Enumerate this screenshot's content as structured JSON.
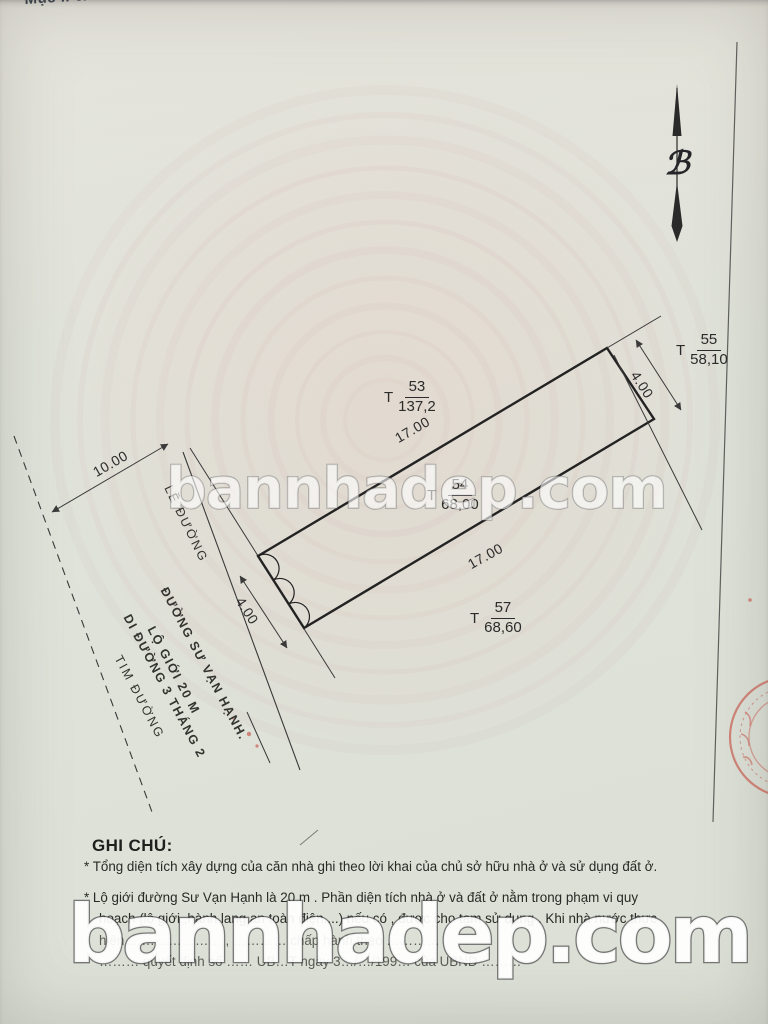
{
  "document": {
    "corner_note": "Mục II c/ Số 3",
    "notes": {
      "title": "GHI CHÚ:",
      "lines": [
        "* Tổng diện tích xây dựng của căn nhà ghi theo lời khai của chủ sở hữu nhà ở và sử dụng đất ở.",
        "* Lộ giới đường Sư Vạn Hạnh là 20 m . Phần diện tích nhà ở và đất ở nằm trong phạm vi quy",
        "hoạch (lộ giới ,hành lang an toàn điện....) nếu có , được cho tạm sử dụng . Khi nhà nước thực",
        "hiện ………………… , ………… chấp hành theo …………",
        "……… quyết định số …… UB…T ngày 3…/…/199… của UBND ………"
      ]
    }
  },
  "watermark": {
    "mid": "bannhadep.com",
    "bottom": "bannhadep.com"
  },
  "north_arrow": {
    "glyph": "ℬ"
  },
  "survey": {
    "parcels": [
      {
        "prefix": "T",
        "id": "53",
        "area": "137,2"
      },
      {
        "prefix": "T",
        "id": "54",
        "area": "68,00"
      },
      {
        "prefix": "T",
        "id": "55",
        "area": "58,10"
      },
      {
        "prefix": "T",
        "id": "57",
        "area": "68,60"
      }
    ],
    "dimensions": {
      "top_edge": "17.00",
      "bottom_edge": "17.00",
      "left_edge": "4.00",
      "right_edge": "4.00",
      "road_half_width": "10.00"
    },
    "street_labels": {
      "curb": "LỀ ĐƯỜNG",
      "street_name": "ĐƯỜNG SƯ VẠN HẠNH.",
      "road_boundary": "LỘ GIỚI 20 M",
      "to_street": "DI ĐƯỜNG 3 THÁNG 2",
      "centerline": "TIM ĐƯỜNG"
    }
  },
  "colors": {
    "paper": "#dfe3da",
    "ink": "#2e2e2e",
    "stamp_red": "#c23a2e",
    "guilloche_pink": "#c98e80"
  }
}
